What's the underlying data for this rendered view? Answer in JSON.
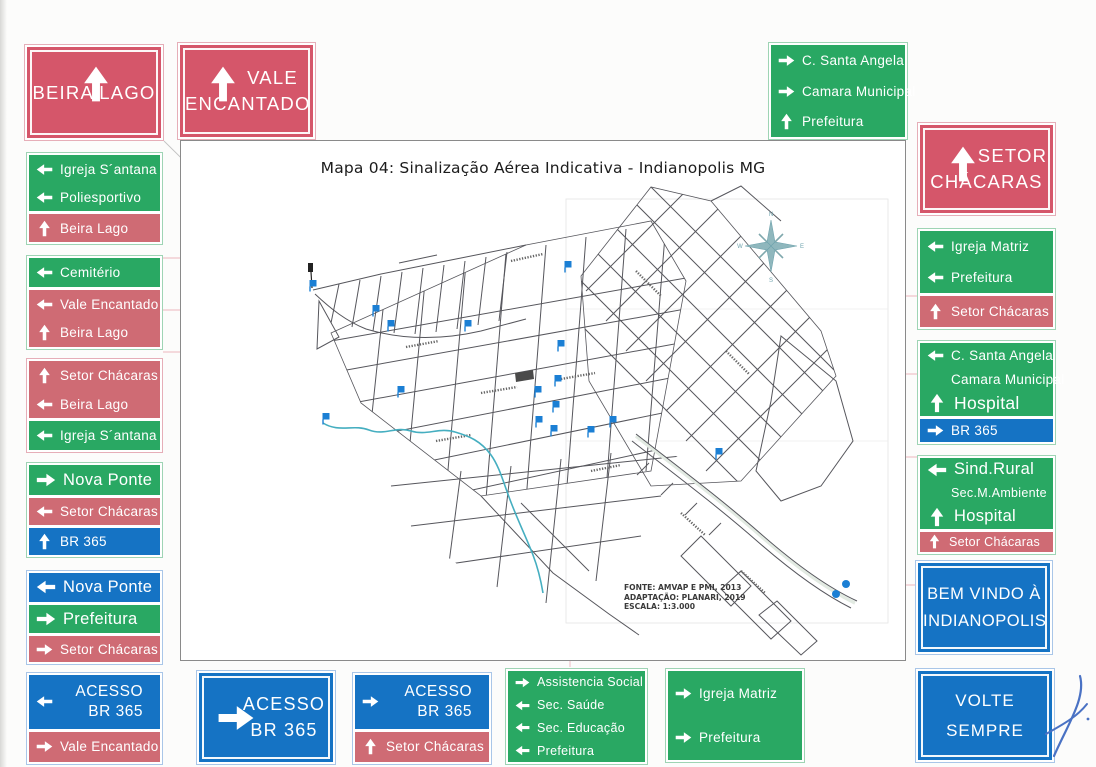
{
  "map": {
    "title": "Mapa 04: Sinalização Aérea Indicativa - Indianopolis MG",
    "source": [
      "FONTE: AMVAP E PMI, 2013",
      "ADAPTAÇÃO: PLANARI, 2019",
      "ESCALA: 1:3.000"
    ],
    "compass_points": [
      "N",
      "S",
      "E",
      "W"
    ],
    "markers": [
      {
        "x": 132,
        "y": 147
      },
      {
        "x": 195,
        "y": 172
      },
      {
        "x": 210,
        "y": 187
      },
      {
        "x": 287,
        "y": 187
      },
      {
        "x": 387,
        "y": 128
      },
      {
        "x": 380,
        "y": 207
      },
      {
        "x": 377,
        "y": 242
      },
      {
        "x": 357,
        "y": 253
      },
      {
        "x": 220,
        "y": 253
      },
      {
        "x": 145,
        "y": 280
      },
      {
        "x": 375,
        "y": 268
      },
      {
        "x": 358,
        "y": 283
      },
      {
        "x": 373,
        "y": 292
      },
      {
        "x": 410,
        "y": 293
      },
      {
        "x": 432,
        "y": 283
      },
      {
        "x": 538,
        "y": 315
      },
      {
        "x": 665,
        "y": 443,
        "dot": true
      },
      {
        "x": 655,
        "y": 453,
        "dot": true
      }
    ]
  },
  "colors": {
    "sign_red_big": "#d5566a",
    "sign_red_strip": "#cf6b74",
    "sign_green": "#29a863",
    "sign_blue": "#1573c4",
    "marker_blue": "#1b7fd4",
    "river_teal": "#45aec0"
  },
  "signs": [
    {
      "id": "beira-lago-top",
      "type": "big",
      "color": "redbig",
      "layout": "arrow-top",
      "arrow": "up",
      "lines": [
        "BEIRA LAGO"
      ]
    },
    {
      "id": "vale-encantado-top",
      "type": "big",
      "color": "redbig",
      "layout": "arrow-left-top",
      "arrow": "up",
      "lines": [
        "VALE",
        "ENCANTADO"
      ]
    },
    {
      "id": "santa-angela-top",
      "type": "group",
      "blocks": [
        {
          "color": "green",
          "rows": [
            {
              "arrow": "right",
              "text": "C. Santa Angela",
              "size": "md"
            },
            {
              "arrow": "right",
              "text": "Camara Municipal",
              "size": "md"
            },
            {
              "arrow": "up",
              "text": "Prefeitura",
              "size": "md"
            }
          ]
        }
      ]
    },
    {
      "id": "setor-chacaras-top",
      "type": "big",
      "color": "redbig",
      "layout": "arrow-left-top",
      "arrow": "up",
      "lines": [
        "SETOR",
        "CHÁCARAS"
      ]
    },
    {
      "id": "igreja-santana-left",
      "type": "group",
      "blocks": [
        {
          "color": "green",
          "rows": [
            {
              "arrow": "left",
              "text": "Igreja S´antana",
              "size": "md"
            },
            {
              "arrow": "left",
              "text": "Poliesportivo",
              "size": "md"
            }
          ]
        },
        {
          "color": "red",
          "rows": [
            {
              "arrow": "up",
              "text": "Beira Lago",
              "size": "md"
            }
          ]
        }
      ]
    },
    {
      "id": "cemiterio-left",
      "type": "group",
      "blocks": [
        {
          "color": "green",
          "rows": [
            {
              "arrow": "left",
              "text": "Cemitério",
              "size": "md"
            }
          ]
        },
        {
          "color": "red",
          "rows": [
            {
              "arrow": "left",
              "text": "Vale Encantado",
              "size": "md"
            },
            {
              "arrow": "up",
              "text": "Beira Lago",
              "size": "md"
            }
          ]
        }
      ]
    },
    {
      "id": "setor-chacaras-left",
      "type": "group",
      "blocks": [
        {
          "color": "red",
          "rows": [
            {
              "arrow": "up",
              "text": "Setor Chácaras",
              "size": "md"
            },
            {
              "arrow": "left",
              "text": "Beira Lago",
              "size": "md"
            }
          ]
        },
        {
          "color": "green",
          "rows": [
            {
              "arrow": "left",
              "text": "Igreja S´antana",
              "size": "md"
            }
          ]
        }
      ]
    },
    {
      "id": "nova-ponte-left-a",
      "type": "group",
      "blocks": [
        {
          "color": "green",
          "rows": [
            {
              "arrow": "right",
              "text": "Nova Ponte",
              "size": "lg"
            }
          ]
        },
        {
          "color": "red",
          "rows": [
            {
              "arrow": "left",
              "text": "Setor Chácaras",
              "size": "md"
            }
          ]
        },
        {
          "color": "blue",
          "rows": [
            {
              "arrow": "up",
              "text": "BR 365",
              "size": "md"
            }
          ]
        }
      ]
    },
    {
      "id": "nova-ponte-left-b",
      "type": "group",
      "blocks": [
        {
          "color": "blue",
          "rows": [
            {
              "arrow": "left",
              "text": "Nova Ponte",
              "size": "lg"
            }
          ]
        },
        {
          "color": "green",
          "rows": [
            {
              "arrow": "right",
              "text": "Prefeitura",
              "size": "lg"
            }
          ]
        },
        {
          "color": "red",
          "rows": [
            {
              "arrow": "right",
              "text": "Setor Chácaras",
              "size": "md"
            }
          ]
        }
      ]
    },
    {
      "id": "acesso-bottom-left",
      "type": "group",
      "blocks": [
        {
          "color": "blue",
          "rows": [
            {
              "arrow": "left",
              "lines": [
                "ACESSO",
                "BR 365"
              ],
              "size": "md"
            }
          ]
        },
        {
          "color": "red",
          "rows": [
            {
              "arrow": "right",
              "text": "Vale Encantado",
              "size": "md"
            }
          ]
        }
      ]
    },
    {
      "id": "acesso-bottom-big",
      "type": "big",
      "color": "blue",
      "layout": "arrow-left-mid",
      "arrow": "right",
      "lines": [
        "ACESSO",
        "BR 365"
      ]
    },
    {
      "id": "acesso-bottom-mid",
      "type": "group",
      "blocks": [
        {
          "color": "blue",
          "rows": [
            {
              "arrow": "right",
              "lines": [
                "ACESSO",
                "BR 365"
              ],
              "size": "md"
            }
          ]
        },
        {
          "color": "red",
          "rows": [
            {
              "arrow": "up",
              "text": "Setor Chácaras",
              "size": "md"
            }
          ]
        }
      ]
    },
    {
      "id": "assistencia-bottom",
      "type": "group",
      "blocks": [
        {
          "color": "green",
          "rows": [
            {
              "arrow": "right",
              "text": "Assistencia Social",
              "size": "sm"
            },
            {
              "arrow": "left",
              "text": "Sec. Saúde",
              "size": "sm"
            },
            {
              "arrow": "left",
              "text": "Sec. Educação",
              "size": "sm"
            },
            {
              "arrow": "left",
              "text": "Prefeitura",
              "size": "sm"
            }
          ]
        }
      ]
    },
    {
      "id": "igreja-matriz-bottom",
      "type": "group",
      "blocks": [
        {
          "color": "green",
          "rows": [
            {
              "arrow": "right",
              "text": "Igreja Matriz",
              "size": "md"
            },
            {
              "arrow": "right",
              "text": "Prefeitura",
              "size": "md"
            }
          ]
        }
      ]
    },
    {
      "id": "volte-sempre-bottom",
      "type": "big",
      "color": "blue",
      "layout": "no-arrow",
      "lines": [
        "VOLTE",
        "SEMPRE"
      ]
    },
    {
      "id": "igreja-matriz-right",
      "type": "group",
      "blocks": [
        {
          "color": "green",
          "rows": [
            {
              "arrow": "left",
              "text": "Igreja Matriz",
              "size": "md"
            },
            {
              "arrow": "left",
              "text": "Prefeitura",
              "size": "md"
            }
          ]
        },
        {
          "color": "red",
          "rows": [
            {
              "arrow": "up",
              "text": "Setor Chácaras",
              "size": "md"
            }
          ]
        }
      ]
    },
    {
      "id": "santa-angela-right",
      "type": "group",
      "blocks": [
        {
          "color": "green",
          "rows": [
            {
              "arrow": "left",
              "text": "C. Santa Angela",
              "size": "md"
            },
            {
              "arrow": "none",
              "text": "Camara Municipal",
              "size": "md"
            },
            {
              "arrow": "up",
              "text": "Hospital",
              "size": "xl"
            }
          ]
        },
        {
          "color": "blue",
          "rows": [
            {
              "arrow": "right",
              "text": "BR 365",
              "size": "md"
            }
          ]
        }
      ]
    },
    {
      "id": "sind-rural-right",
      "type": "group",
      "blocks": [
        {
          "color": "green",
          "rows": [
            {
              "arrow": "left",
              "text": "Sind.Rural",
              "size": "lg"
            },
            {
              "arrow": "none",
              "text": "Sec.M.Ambiente",
              "size": "sm"
            },
            {
              "arrow": "up",
              "text": "Hospital",
              "size": "lg"
            }
          ]
        },
        {
          "color": "red",
          "rows": [
            {
              "arrow": "up",
              "text": "Setor Chácaras",
              "size": "sm"
            }
          ]
        }
      ]
    },
    {
      "id": "bem-vindo-right",
      "type": "big",
      "color": "blue",
      "layout": "no-arrow",
      "lines": [
        "BEM VINDO À",
        "INDIANOPOLIS"
      ]
    }
  ]
}
